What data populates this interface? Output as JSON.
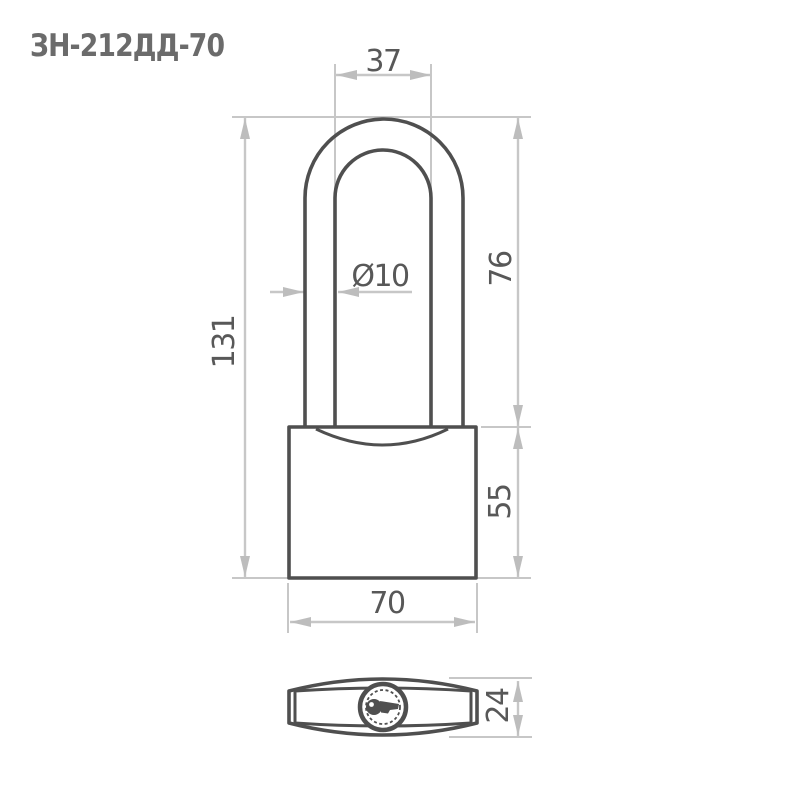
{
  "title": "ЗН-212ДД-70",
  "colors": {
    "background": "#ffffff",
    "outline": "#4f4f4f",
    "dim_line": "#c7c7c7",
    "arrow": "#bdbdbd",
    "dim_text": "#585858",
    "title_text": "#6b6b6b"
  },
  "dimensions": {
    "shackle_width": "37",
    "shackle_diameter": "Ø10",
    "shackle_height": "76",
    "overall_height": "131",
    "body_height": "55",
    "body_width": "70",
    "body_depth": "24"
  }
}
